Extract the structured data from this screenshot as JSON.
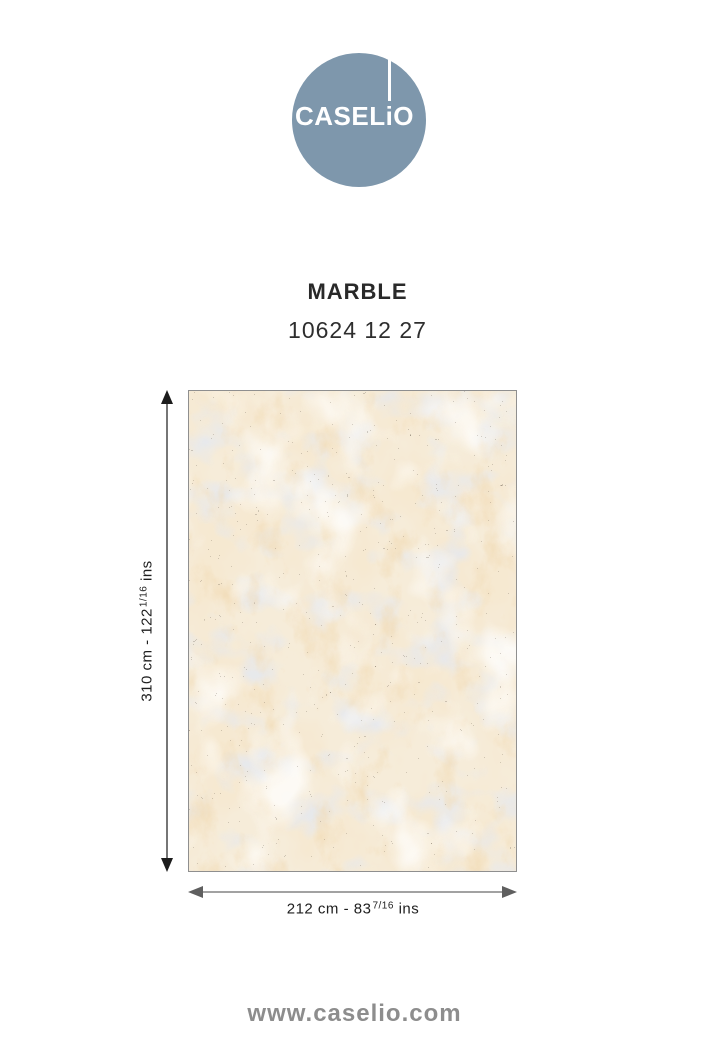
{
  "brand": {
    "logo_text": "CASELiO",
    "logo_color": "#7e97ac",
    "website": "www.caselio.com"
  },
  "product": {
    "name": "MARBLE",
    "reference": "10624 12 27"
  },
  "dimensions": {
    "height": {
      "prefix": "310 cm - 122",
      "fraction": "1/16",
      "suffix": " ins"
    },
    "width": {
      "prefix": "212 cm - 83",
      "fraction": "7/16",
      "suffix": " ins"
    }
  },
  "swatch": {
    "texture": "marble",
    "base_color": "#f6ecd9",
    "vein_color": "#e9cda2",
    "accent_color": "#c7cedd",
    "speckle_color": "#201a11"
  }
}
